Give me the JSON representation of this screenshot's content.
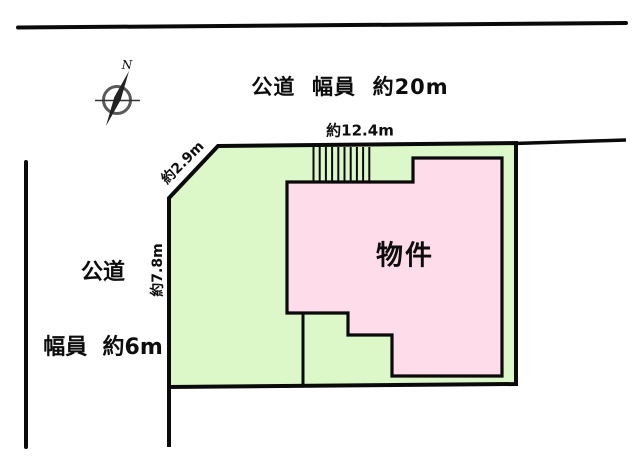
{
  "colors": {
    "land_fill": "#dcf8c9",
    "building_fill": "#ffdce9",
    "line": "#0a0a0a",
    "compass_ring": "#5a5a5a",
    "compass_needle": "#222222"
  },
  "north_road": {
    "label": "公道  幅員  約20m"
  },
  "west_road": {
    "label_line1": "公道",
    "label_line2": "幅員  約6m"
  },
  "dimensions": {
    "top_frontage": "約12.4m",
    "corner_frontage": "約2.9m",
    "left_frontage": "約7.8m"
  },
  "building": {
    "label": "物件"
  },
  "compass": {
    "north": "N"
  }
}
